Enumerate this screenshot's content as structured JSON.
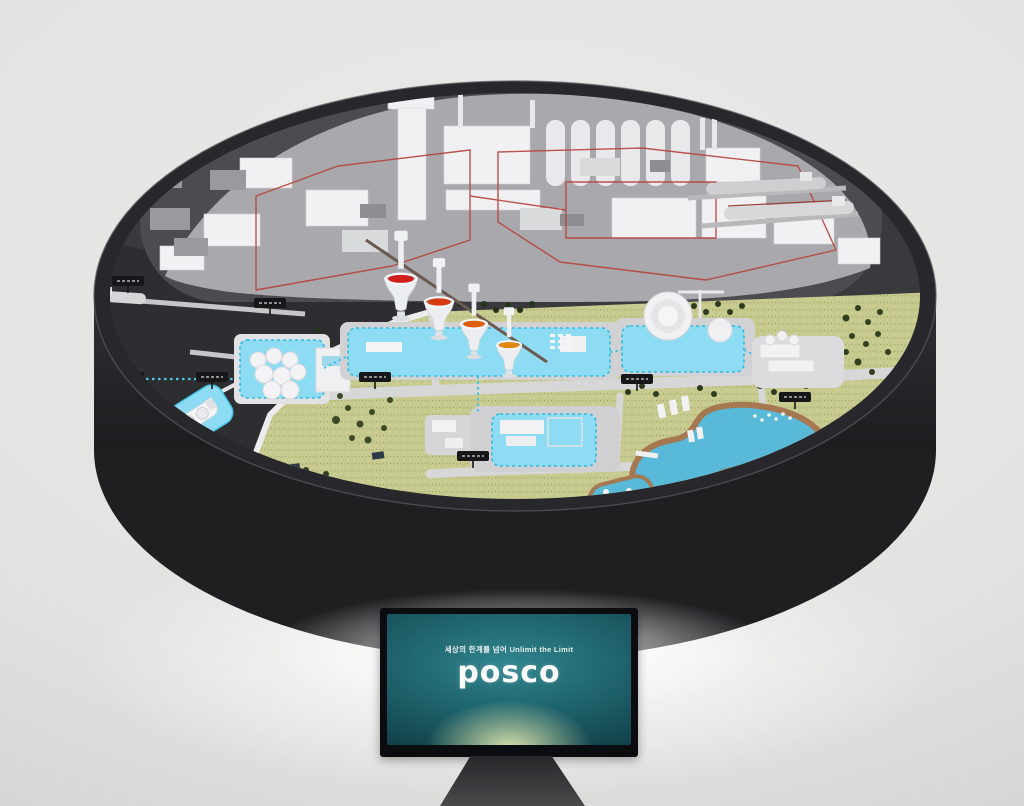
{
  "monitor": {
    "tagline": "세상의 한계를 넘어 Unlimit the Limit",
    "brand": "posco"
  },
  "colors": {
    "background": "#e6e6e5",
    "table": "#2a2a2e",
    "model_base": "#3a3a3e",
    "industrial_zone": "#a9a9ad",
    "terrain_green": "#c7ca8e",
    "tree_green": "#2e3b1f",
    "hydrogen_pad_cyan": "#8edcf4",
    "pipeline_cyan": "#3cc6ea",
    "pipeline_red": "#b5433a",
    "molten_red": "#cf1f1a",
    "molten_orange": "#e2860f",
    "water_blue": "#58b9d8",
    "riverbank_brown": "#a57852",
    "screen_teal": "#1d6a74",
    "floor_glow": "#ffffff"
  },
  "model": {
    "hopper_count": 4,
    "facility_marker_count": 8
  }
}
